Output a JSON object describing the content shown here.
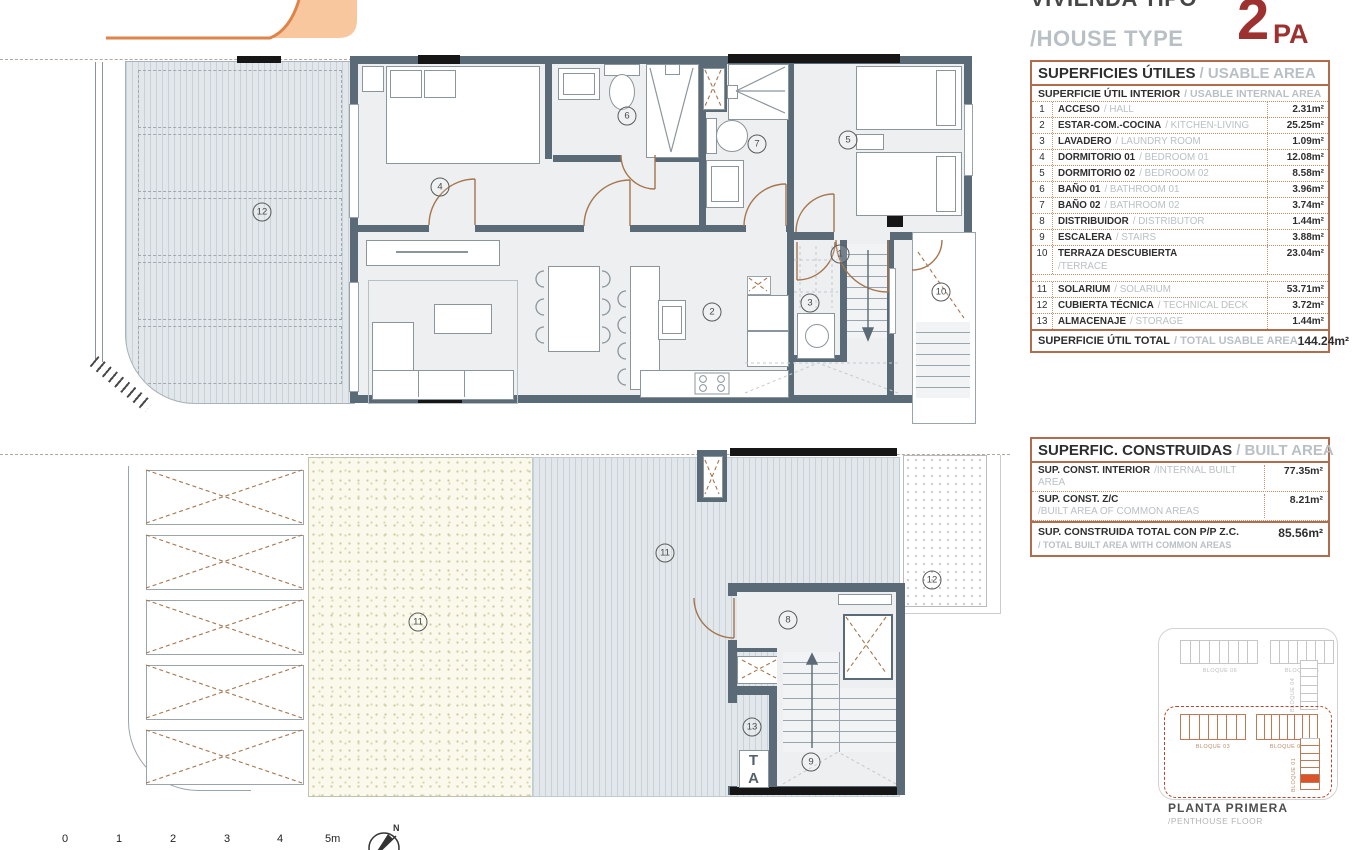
{
  "header": {
    "title_es": "VIVIENDA TIPO",
    "title_en": "/HOUSE TYPE",
    "type_code_big": "2",
    "type_code_small": "PA"
  },
  "usable_area_table": {
    "title_es": "SUPERFICIES ÚTILES",
    "title_en": "/ USABLE AREA",
    "subtitle_es": "SUPERFICIE ÚTIL INTERIOR",
    "subtitle_en": "/ USABLE INTERNAL AREA",
    "rows": [
      {
        "num": "1",
        "name_es": "ACCESO",
        "name_en": "/ HALL",
        "area": "2.31m²"
      },
      {
        "num": "2",
        "name_es": "ESTAR-COM.-COCINA",
        "name_en": "/ KITCHEN-LIVING",
        "area": "25.25m²"
      },
      {
        "num": "3",
        "name_es": "LAVADERO",
        "name_en": "/ LAUNDRY ROOM",
        "area": "1.09m²"
      },
      {
        "num": "4",
        "name_es": "DORMITORIO 01",
        "name_en": "/ BEDROOM 01",
        "area": "12.08m²"
      },
      {
        "num": "5",
        "name_es": "DORMITORIO 02",
        "name_en": "/ BEDROOM 02",
        "area": "8.58m²"
      },
      {
        "num": "6",
        "name_es": "BAÑO 01",
        "name_en": "/ BATHROOM 01",
        "area": "3.96m²"
      },
      {
        "num": "7",
        "name_es": "BAÑO 02",
        "name_en": "/ BATHROOM 02",
        "area": "3.74m²"
      },
      {
        "num": "8",
        "name_es": "DISTRIBUIDOR",
        "name_en": "/ DISTRIBUTOR",
        "area": "1.44m²"
      },
      {
        "num": "9",
        "name_es": "ESCALERA",
        "name_en": "/ STAIRS",
        "area": "3.88m²"
      },
      {
        "num": "10",
        "name_es": "TERRAZA DESCUBIERTA",
        "name_en": "/TERRACE",
        "area": "23.04m²",
        "two_line": true
      },
      {
        "num": "11",
        "name_es": "SOLARIUM",
        "name_en": "/ SOLARIUM",
        "area": "53.71m²"
      },
      {
        "num": "12",
        "name_es": "CUBIERTA TÉCNICA",
        "name_en": "/ TECHNICAL DECK",
        "area": "3.72m²"
      },
      {
        "num": "13",
        "name_es": "ALMACENAJE",
        "name_en": "/ STORAGE",
        "area": "1.44m²"
      }
    ],
    "total_es": "SUPERFICIE ÚTIL TOTAL",
    "total_en": "/ TOTAL USABLE AREA",
    "total_area": "144.24m²"
  },
  "built_area_table": {
    "title_es": "SUPERFIC. CONSTRUIDAS",
    "title_en": "/ BUILT AREA",
    "rows": [
      {
        "line1": "SUP. CONST. INTERIOR",
        "line1_en": "/INTERNAL BUILT AREA",
        "area": "77.35m²"
      },
      {
        "line1": "SUP. CONST. Z/C",
        "line2": "/BUILT AREA OF COMMON AREAS",
        "area": "8.21m²"
      }
    ],
    "total_line1": "SUP. CONSTRUIDA TOTAL CON P/P Z.C.",
    "total_line2": "/ TOTAL BUILT AREA WITH COMMON AREAS",
    "total_area": "85.56m²"
  },
  "floor_plans": {
    "upper_labels": [
      {
        "n": "1",
        "x": 840,
        "y": 254
      },
      {
        "n": "2",
        "x": 712,
        "y": 312
      },
      {
        "n": "3",
        "x": 810,
        "y": 303
      },
      {
        "n": "4",
        "x": 440,
        "y": 187
      },
      {
        "n": "5",
        "x": 848,
        "y": 140
      },
      {
        "n": "6",
        "x": 627,
        "y": 116
      },
      {
        "n": "7",
        "x": 757,
        "y": 144
      },
      {
        "n": "10",
        "x": 941,
        "y": 292
      },
      {
        "n": "12",
        "x": 262,
        "y": 212
      }
    ],
    "lower_labels": [
      {
        "n": "8",
        "x": 788,
        "y": 620
      },
      {
        "n": "9",
        "x": 811,
        "y": 762
      },
      {
        "n": "11",
        "x": 418,
        "y": 622
      },
      {
        "n": "11",
        "x": 665,
        "y": 553
      },
      {
        "n": "12",
        "x": 932,
        "y": 580
      },
      {
        "n": "13",
        "x": 752,
        "y": 727
      }
    ],
    "storage_tag": "TA"
  },
  "site_plan": {
    "blocks_outside": [
      {
        "label": "BLOQUE 06",
        "cells": 8
      },
      {
        "label": "BLOQUE 05",
        "cells": 7
      },
      {
        "label": "BLOQUE 04",
        "cells": 6,
        "vertical": true
      }
    ],
    "blocks_inside": [
      {
        "label": "BLOQUE 03",
        "cells": 7
      },
      {
        "label": "BLOQUE 02",
        "cells": 8
      },
      {
        "label": "BLOQUE 01",
        "cells": 7,
        "vertical": true,
        "highlight_index": 5
      }
    ],
    "caption_line1": "PLANTA PRIMERA",
    "caption_line2": "/PENTHOUSE FLOOR",
    "highlight_color": "#d9542b"
  },
  "scale_bar": {
    "ticks": [
      "0",
      "1",
      "2",
      "3",
      "4",
      "5m"
    ]
  },
  "compass": {
    "label": "N"
  },
  "colors": {
    "wall": "#5a6b77",
    "accent_red": "#9c312f",
    "table_border": "#b26c4b",
    "door_arc": "#a5764f",
    "muted_text": "#b9c0c5",
    "logo_fill": "#f9c79e",
    "logo_stroke": "#de8349",
    "site_highlight": "#d9542b"
  }
}
